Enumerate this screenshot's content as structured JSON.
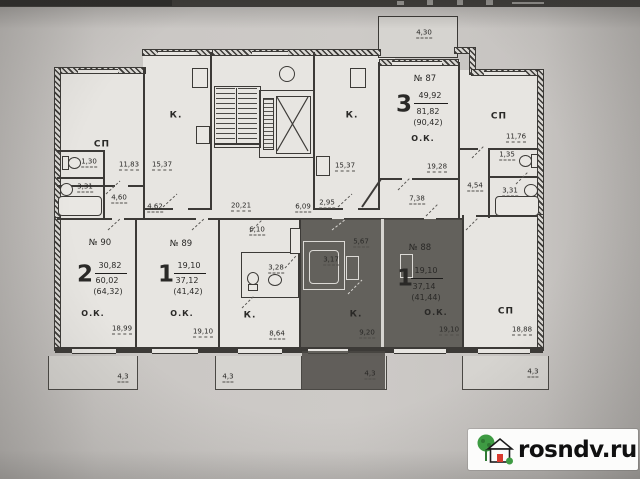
{
  "watermark": {
    "text": "rosndv.ru"
  },
  "plan": {
    "common": {
      "corridor": "20,21",
      "h609": "6,09",
      "h295": "2,95"
    },
    "apt90": {
      "no": "№ 90",
      "rooms": "2",
      "living": "30,82",
      "total": "60,02",
      "with_balcony": "(64,32)",
      "ok_label": "О.К.",
      "ok_area": "18,99",
      "sp_label": "СП",
      "sp_area": "11,83",
      "kitchen_label": "К.",
      "kitchen_area": "15,37",
      "wc_area": "1,30",
      "bath_area": "3,31",
      "hall_area": "4,60",
      "hall2_area": "4,62",
      "balcony": "4,3"
    },
    "apt89": {
      "no": "№ 89",
      "rooms": "1",
      "living": "19,10",
      "total": "37,12",
      "with_balcony": "(41,42)",
      "ok_label": "О.К.",
      "ok_area": "19,10",
      "kitchen_label": "К.",
      "kitchen_area": "8,64",
      "bath_area": "3,28",
      "hall_area": "6,10",
      "balcony": "4,3"
    },
    "apt88": {
      "no": "№ 88",
      "rooms": "1",
      "living": "19,10",
      "total": "37,14",
      "with_balcony": "(41,44)",
      "ok_label": "О.К.",
      "ok_area": "19,10",
      "kitchen_label": "К.",
      "kitchen_area": "9,20",
      "bath_area": "3,17",
      "hall_area": "5,67",
      "balcony": "4,3"
    },
    "apt87": {
      "no": "№ 87",
      "rooms": "3",
      "living": "49,92",
      "total": "81,82",
      "with_balcony": "(90,42)",
      "ok_label": "О.К.",
      "ok_area": "19,28",
      "kitchen_label": "К.",
      "kitchen_area": "15,37",
      "sp_label": "СП",
      "sp_area": "11,76",
      "sp2_label": "СП",
      "sp2_area": "18,88",
      "wc_area": "1,35",
      "bath_area": "3,31",
      "hall_area": "4,54",
      "hall2_area": "7,38",
      "balcony_top": "4,30",
      "balcony": "4,3"
    }
  }
}
